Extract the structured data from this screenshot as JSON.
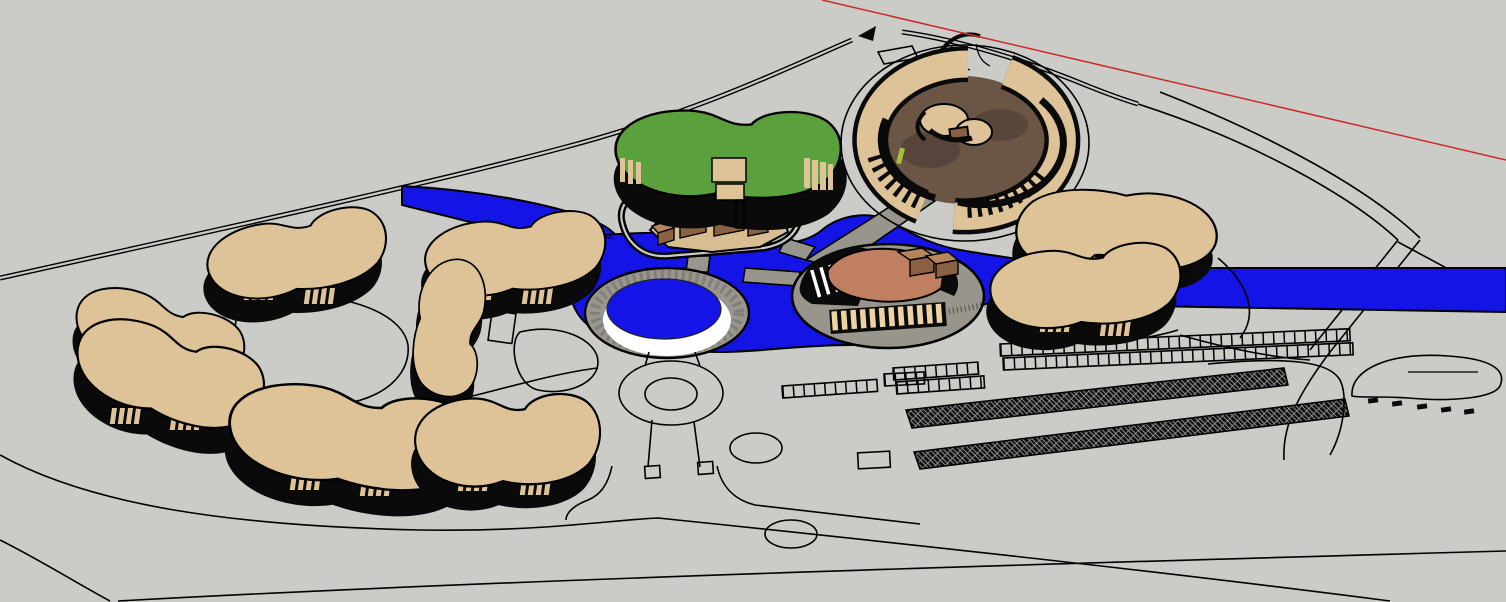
{
  "scene": {
    "viewport": {
      "width": 1506,
      "height": 602
    },
    "colors": {
      "background": "#cbcbc7",
      "outline": "#000000",
      "water": "#1414e6",
      "building_tan": "#ddc397",
      "roof_green": "#5aa03c",
      "shadow_black": "#0a0a0a",
      "path_gray": "#98958d",
      "courtyard_brown": "#6b5646",
      "courtyard_dark": "#57443a",
      "terrace_salmon": "#c07f60",
      "cube_top": "#b5855c",
      "cube_side": "#8a6243",
      "platform_tan": "#d9bd92",
      "louver_tan": "#ecd3a2",
      "grass_green": "#a7bf3d",
      "axis_red": "#cc2a2a",
      "pool_rim_white": "#ffffff",
      "ring_gray": "#99968e"
    },
    "objects": [
      {
        "id": "red-axis-line",
        "label": "red drawing axis guide line"
      },
      {
        "id": "perimeter-road",
        "label": "double-line perimeter road"
      },
      {
        "id": "water-canal",
        "label": "blue canal and lake"
      },
      {
        "id": "central-pool",
        "label": "circular pool with ring walkway"
      },
      {
        "id": "roundabout",
        "label": "road roundabout"
      },
      {
        "id": "green-roof-building",
        "label": "green-roof kidney building"
      },
      {
        "id": "courtyard-compound",
        "label": "circular courtyard compound with domes"
      },
      {
        "id": "island-pavilion",
        "label": "oval island pavilion with louvers"
      },
      {
        "id": "central-plaza",
        "label": "plaza platform with cubic volumes"
      },
      {
        "id": "kidney-building",
        "label": "tan kidney-shaped building",
        "count": 9
      },
      {
        "id": "parking-stall-row",
        "label": "outlined parking stall rows",
        "count": 6
      },
      {
        "id": "parking-canopy",
        "label": "cross-hatched parking canopy strip",
        "count": 2
      },
      {
        "id": "parked-cars",
        "label": "small parked car shapes",
        "count": 5
      },
      {
        "id": "site-boundary",
        "label": "curved site boundary lines"
      }
    ]
  }
}
